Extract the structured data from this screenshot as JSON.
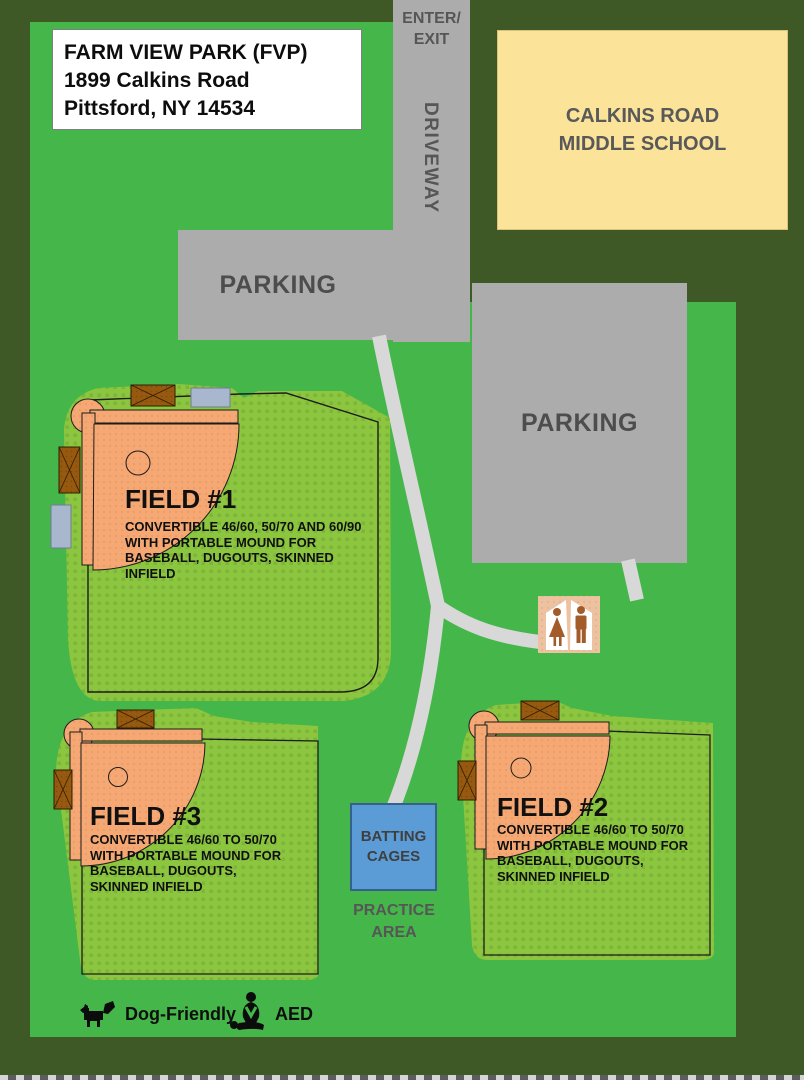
{
  "map": {
    "title_box": {
      "line1": "FARM VIEW PARK (FVP)",
      "line2": "1899 Calkins Road",
      "line3": "Pittsford, NY 14534"
    },
    "driveway": {
      "enter_exit_line1": "ENTER/",
      "enter_exit_line2": "EXIT",
      "label": "DRIVEWAY"
    },
    "school": {
      "line1": "CALKINS ROAD",
      "line2": "MIDDLE SCHOOL"
    },
    "parking_upper_label": "PARKING",
    "parking_lower_label": "PARKING",
    "fields": [
      {
        "name": "FIELD #1",
        "description": "CONVERTIBLE 46/60, 50/70 AND 60/90 WITH PORTABLE MOUND FOR BASEBALL, DUGOUTS, SKINNED INFIELD"
      },
      {
        "name": "FIELD #2",
        "description": "CONVERTIBLE 46/60 TO 50/70 WITH PORTABLE MOUND FOR BASEBALL, DUGOUTS, SKINNED INFIELD"
      },
      {
        "name": "FIELD #3",
        "description": "CONVERTIBLE 46/60 TO 50/70 WITH PORTABLE MOUND FOR BASEBALL, DUGOUTS, SKINNED INFIELD"
      }
    ],
    "batting_cages": {
      "line1": "BATTING",
      "line2": "CAGES"
    },
    "practice_area": {
      "line1": "PRACTICE",
      "line2": "AREA"
    },
    "legend": {
      "dog_label": "Dog-Friendly",
      "aed_label": "AED"
    },
    "icons": {
      "dog": "dog-icon",
      "aed": "aed-cpr-icon",
      "restroom": "restroom-icon"
    },
    "colors": {
      "background_dark_green": "#3E5826",
      "park_green": "#45B649",
      "field_turf_green": "#8CC63E",
      "infield_orange": "#F5A873",
      "pavement_gray": "#ACACAC",
      "walkway_gray": "#D8D8D8",
      "school_yellow": "#FBE39A",
      "batting_cage_blue": "#5C9CD6",
      "dugout_brown": "#96590F",
      "bleacher_gray_blue": "#A8B7CD",
      "restroom_tan": "#EDC2A0",
      "label_gray": "#595959"
    }
  }
}
